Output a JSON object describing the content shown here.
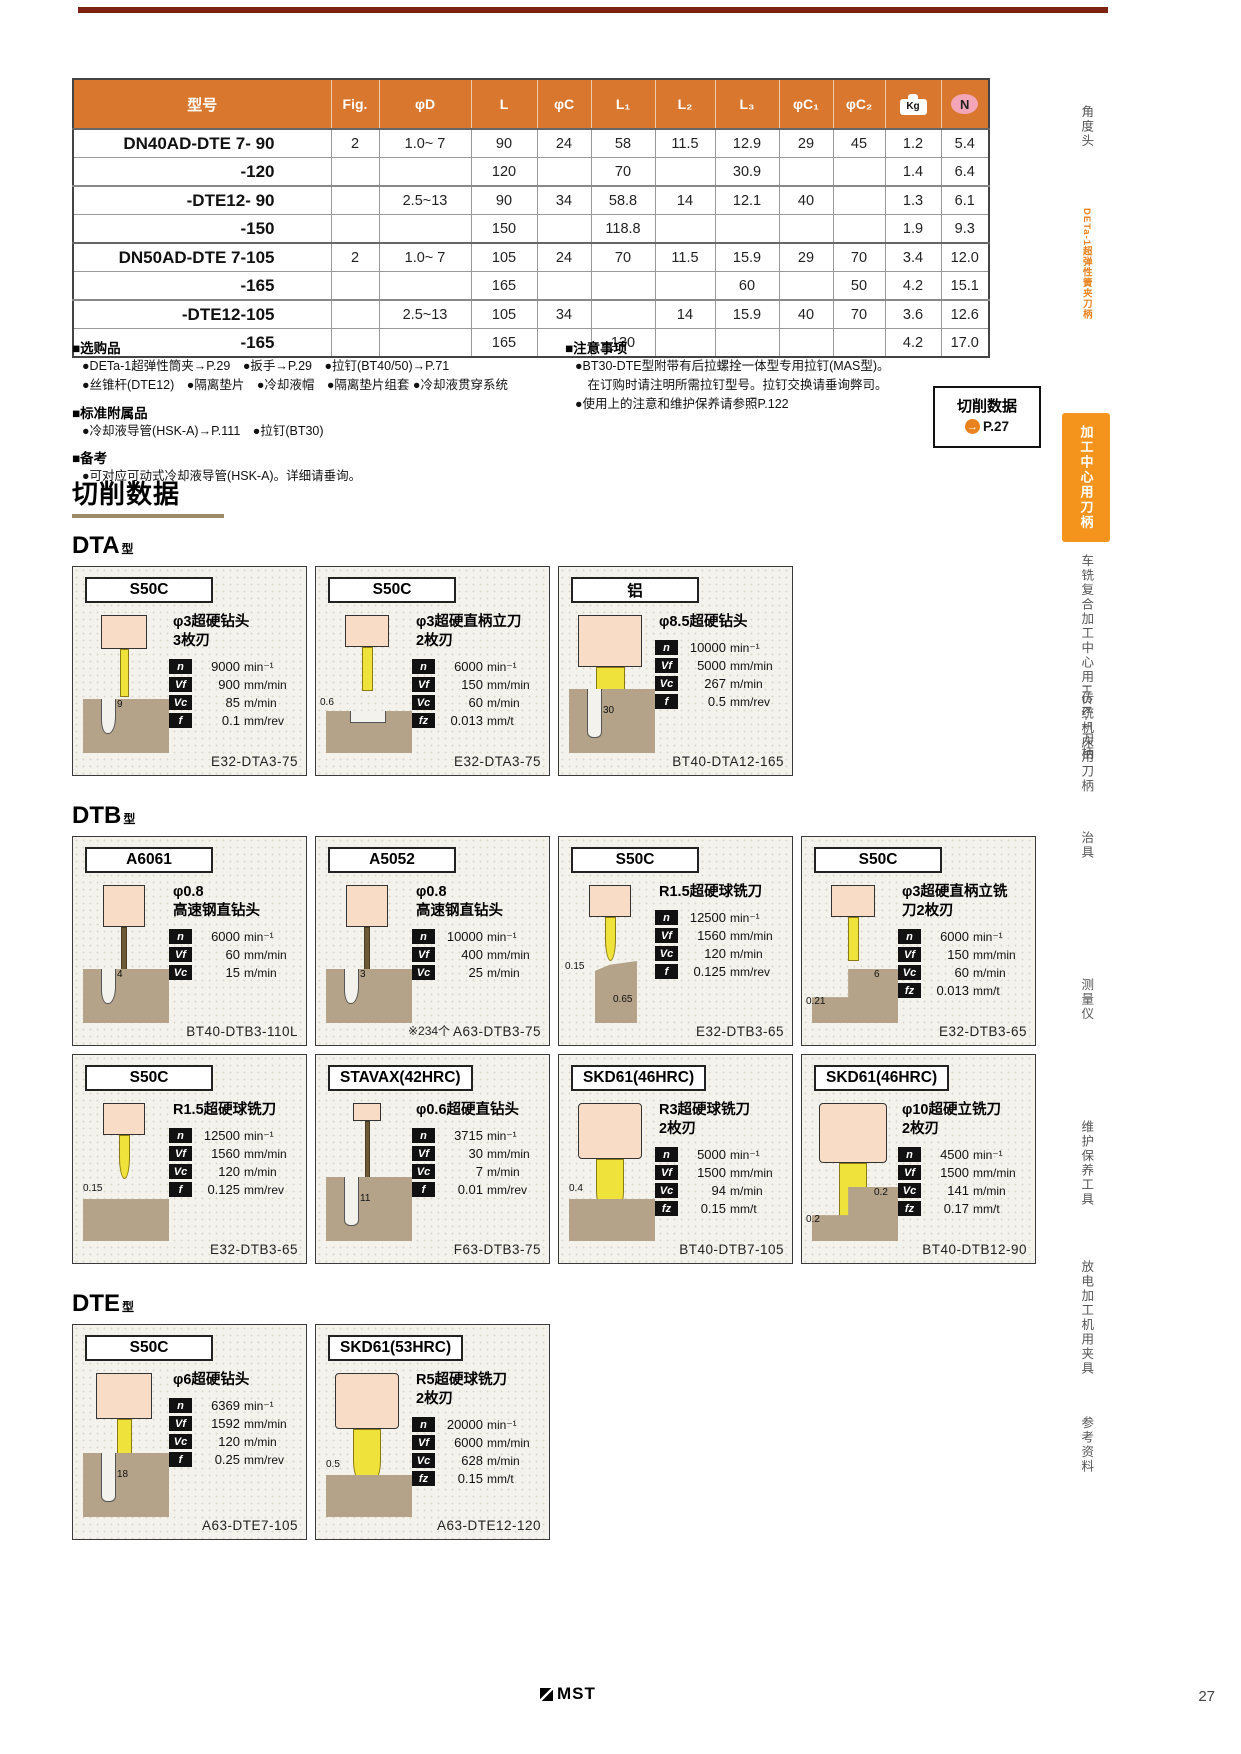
{
  "page": {
    "number": "27",
    "footer_brand": "MST"
  },
  "colors": {
    "table_header_orange": "#d9772e",
    "sidebar_active_orange": "#f5941d",
    "top_rule_maroon": "#7e2211",
    "n_badge_pink": "#f2a6b8",
    "diagram_tan": "#b4a389",
    "drill_yellow": "#efe23a",
    "holder_pink": "#f8dcc6"
  },
  "spec_table": {
    "col_headers": [
      "型号",
      "Fig.",
      "φD",
      "L",
      "φC",
      "L₁",
      "L₂",
      "L₃",
      "φC₁",
      "φC₂",
      "Kg",
      "N"
    ],
    "rows": [
      {
        "model": "DN40AD-DTE 7- 90",
        "shade": "lf",
        "sep": "group",
        "cells": [
          "2",
          "1.0~ 7",
          "90",
          "24",
          "58",
          "11.5",
          "12.9",
          "29",
          "45",
          "1.2",
          "5.4"
        ]
      },
      {
        "model": "-120",
        "shade": "l",
        "cells": [
          "",
          "",
          "120",
          "",
          "70",
          "",
          "30.9",
          "",
          "",
          "1.4",
          "6.4"
        ]
      },
      {
        "model": "-DTE12- 90",
        "shade": "l",
        "sep": "sub",
        "cells": [
          "",
          "2.5~13",
          "90",
          "34",
          "58.8",
          "14",
          "12.1",
          "40",
          "",
          "1.3",
          "6.1"
        ]
      },
      {
        "model": "-150",
        "shade": "l",
        "cells": [
          "",
          "",
          "150",
          "",
          "118.8",
          "",
          "",
          "",
          "",
          "1.9",
          "9.3"
        ]
      },
      {
        "model": "DN50AD-DTE 7-105",
        "shade": "df",
        "sep": "group",
        "cells": [
          "2",
          "1.0~ 7",
          "105",
          "24",
          "70",
          "11.5",
          "15.9",
          "29",
          "70",
          "3.4",
          "12.0"
        ]
      },
      {
        "model": "-165",
        "shade": "d",
        "cells": [
          "",
          "",
          "165",
          "",
          "",
          "",
          "60",
          "",
          "50",
          "4.2",
          "15.1"
        ]
      },
      {
        "model": "-DTE12-105",
        "shade": "d",
        "sep": "sub",
        "cells": [
          "",
          "2.5~13",
          "105",
          "34",
          "",
          "14",
          "15.9",
          "40",
          "70",
          "3.6",
          "12.6"
        ]
      },
      {
        "model": "-165",
        "shade": "d",
        "cells": [
          "",
          "",
          "165",
          "",
          "130",
          "",
          "",
          "",
          "",
          "4.2",
          "17.0"
        ]
      }
    ]
  },
  "notes_left": [
    {
      "title": "■选购品",
      "lines": [
        "●DETa-1超弹性筒夹→P.29　●扳手→P.29　●拉钉(BT40/50)→P.71",
        "●丝锥杆(DTE12)　●隔离垫片　●冷却液帽　●隔离垫片组套 ●冷却液贯穿系统"
      ]
    },
    {
      "title": "■标准附属品",
      "lines": [
        "●冷却液导管(HSK-A)→P.111　●拉钉(BT30)"
      ]
    },
    {
      "title": "■备考",
      "lines": [
        "●可对应可动式冷却液导管(HSK-A)。详细请垂询。"
      ]
    }
  ],
  "notes_right": [
    {
      "title": "■注意事项",
      "lines": [
        "●BT30-DTE型附带有后拉螺拴一体型专用拉钉(MAS型)。",
        "　在订购时请注明所需拉钉型号。拉钉交换请垂询弊司。",
        "●使用上的注意和维护保养请参照P.122"
      ]
    }
  ],
  "cutting_ref": {
    "title": "切削数据",
    "arrow": "→",
    "page": "P.27"
  },
  "cutting_section": {
    "title": "切削数据",
    "groups": [
      {
        "name": "DTA",
        "suffix": "型",
        "rows": [
          [
            {
              "material": "S50C",
              "tool": [
                "φ3超硬钻头",
                "3枚刃"
              ],
              "art": "drill-thin",
              "params": [
                [
                  "n",
                  "9000",
                  "min⁻¹"
                ],
                [
                  "Vf",
                  "900",
                  "mm/min"
                ],
                [
                  "Vc",
                  "85",
                  "m/min"
                ],
                [
                  "f",
                  "0.1",
                  "mm/rev"
                ]
              ],
              "diagram": {
                "type": "hole",
                "dims": [
                  "9"
                ]
              },
              "model": "E32-DTA3-75"
            },
            {
              "material": "S50C",
              "tool": [
                "φ3超硬直柄立刀",
                "2枚刃"
              ],
              "art": "endmill-small",
              "params": [
                [
                  "n",
                  "6000",
                  "min⁻¹"
                ],
                [
                  "Vf",
                  "150",
                  "mm/min"
                ],
                [
                  "Vc",
                  "60",
                  "m/min"
                ],
                [
                  "fz",
                  "0.013",
                  "mm/t"
                ]
              ],
              "diagram": {
                "type": "step",
                "dims": [
                  "0.6"
                ]
              },
              "model": "E32-DTA3-75"
            },
            {
              "material": "铝",
              "tool": [
                "φ8.5超硬钻头"
              ],
              "art": "drill-large",
              "params": [
                [
                  "n",
                  "10000",
                  "min⁻¹"
                ],
                [
                  "Vf",
                  "5000",
                  "mm/min"
                ],
                [
                  "Vc",
                  "267",
                  "m/min"
                ],
                [
                  "f",
                  "0.5",
                  "mm/rev"
                ]
              ],
              "diagram": {
                "type": "deep-hole",
                "dims": [
                  "30"
                ]
              },
              "model": "BT40-DTA12-165"
            }
          ]
        ]
      },
      {
        "name": "DTB",
        "suffix": "型",
        "rows": [
          [
            {
              "material": "A6061",
              "tool": [
                "φ0.8",
                "高速钢直钻头"
              ],
              "art": "drill-hair",
              "params": [
                [
                  "n",
                  "6000",
                  "min⁻¹"
                ],
                [
                  "Vf",
                  "60",
                  "mm/min"
                ],
                [
                  "Vc",
                  "15",
                  "m/min"
                ]
              ],
              "diagram": {
                "type": "hole",
                "dims": [
                  "4"
                ]
              },
              "model": "BT40-DTB3-110L"
            },
            {
              "material": "A5052",
              "tool": [
                "φ0.8",
                "高速钢直钻头"
              ],
              "art": "drill-hair",
              "params": [
                [
                  "n",
                  "10000",
                  "min⁻¹"
                ],
                [
                  "Vf",
                  "400",
                  "mm/min"
                ],
                [
                  "Vc",
                  "25",
                  "m/min"
                ]
              ],
              "diagram": {
                "type": "hole",
                "dims": [
                  "3"
                ]
              },
              "note": "※234个",
              "model": "A63-DTB3-75"
            },
            {
              "material": "S50C",
              "tool": [
                "R1.5超硬球铣刀"
              ],
              "art": "ballmill-small",
              "params": [
                [
                  "n",
                  "12500",
                  "min⁻¹"
                ],
                [
                  "Vf",
                  "1560",
                  "mm/min"
                ],
                [
                  "Vc",
                  "120",
                  "m/min"
                ],
                [
                  "f",
                  "0.125",
                  "mm/rev"
                ]
              ],
              "diagram": {
                "type": "corner",
                "dims": [
                  "0.15",
                  "0.65"
                ]
              },
              "model": "E32-DTB3-65"
            },
            {
              "material": "S50C",
              "tool": [
                "φ3超硬直柄立铣",
                "刀2枚刃"
              ],
              "art": "endmill-small",
              "params": [
                [
                  "n",
                  "6000",
                  "min⁻¹"
                ],
                [
                  "Vf",
                  "150",
                  "mm/min"
                ],
                [
                  "Vc",
                  "60",
                  "m/min"
                ],
                [
                  "fz",
                  "0.013",
                  "mm/t"
                ]
              ],
              "diagram": {
                "type": "lstep",
                "dims": [
                  "6",
                  "0.21"
                ]
              },
              "model": "E32-DTB3-65"
            }
          ],
          [
            {
              "material": "S50C",
              "tool": [
                "R1.5超硬球铣刀"
              ],
              "art": "ballmill-small",
              "params": [
                [
                  "n",
                  "12500",
                  "min⁻¹"
                ],
                [
                  "Vf",
                  "1560",
                  "mm/min"
                ],
                [
                  "Vc",
                  "120",
                  "m/min"
                ],
                [
                  "f",
                  "0.125",
                  "mm/rev"
                ]
              ],
              "diagram": {
                "type": "surface",
                "dims": [
                  "0.15"
                ]
              },
              "model": "E32-DTB3-65"
            },
            {
              "material": "STAVAX(42HRC)",
              "tool": [
                "φ0.6超硬直钻头"
              ],
              "art": "drill-hair-long",
              "params": [
                [
                  "n",
                  "3715",
                  "min⁻¹"
                ],
                [
                  "Vf",
                  "30",
                  "mm/min"
                ],
                [
                  "Vc",
                  "7",
                  "m/min"
                ],
                [
                  "f",
                  "0.01",
                  "mm/rev"
                ]
              ],
              "diagram": {
                "type": "deep-hole",
                "dims": [
                  "11"
                ]
              },
              "model": "F63-DTB3-75"
            },
            {
              "material": "SKD61(46HRC)",
              "tool": [
                "R3超硬球铣刀",
                "2枚刃"
              ],
              "art": "ballmill-large",
              "params": [
                [
                  "n",
                  "5000",
                  "min⁻¹"
                ],
                [
                  "Vf",
                  "1500",
                  "mm/min"
                ],
                [
                  "Vc",
                  "94",
                  "m/min"
                ],
                [
                  "fz",
                  "0.15",
                  "mm/t"
                ]
              ],
              "diagram": {
                "type": "surface",
                "dims": [
                  "0.4"
                ]
              },
              "model": "BT40-DTB7-105"
            },
            {
              "material": "SKD61(46HRC)",
              "tool": [
                "φ10超硬立铣刀",
                "2枚刃"
              ],
              "art": "endmill-large",
              "params": [
                [
                  "n",
                  "4500",
                  "min⁻¹"
                ],
                [
                  "Vf",
                  "1500",
                  "mm/min"
                ],
                [
                  "Vc",
                  "141",
                  "m/min"
                ],
                [
                  "fz",
                  "0.17",
                  "mm/t"
                ]
              ],
              "diagram": {
                "type": "lstep",
                "dims": [
                  "0.2",
                  "0.2"
                ]
              },
              "model": "BT40-DTB12-90"
            }
          ]
        ]
      },
      {
        "name": "DTE",
        "suffix": "型",
        "rows": [
          [
            {
              "material": "S50C",
              "tool": [
                "φ6超硬钻头"
              ],
              "art": "drill-medium",
              "params": [
                [
                  "n",
                  "6369",
                  "min⁻¹"
                ],
                [
                  "Vf",
                  "1592",
                  "mm/min"
                ],
                [
                  "Vc",
                  "120",
                  "m/min"
                ],
                [
                  "f",
                  "0.25",
                  "mm/rev"
                ]
              ],
              "diagram": {
                "type": "deep-hole",
                "dims": [
                  "18"
                ]
              },
              "model": "A63-DTE7-105"
            },
            {
              "material": "SKD61(53HRC)",
              "tool": [
                "R5超硬球铣刀",
                "2枚刃"
              ],
              "art": "ballmill-large",
              "params": [
                [
                  "n",
                  "20000",
                  "min⁻¹"
                ],
                [
                  "Vf",
                  "6000",
                  "mm/min"
                ],
                [
                  "Vc",
                  "628",
                  "m/min"
                ],
                [
                  "fz",
                  "0.15",
                  "mm/t"
                ]
              ],
              "diagram": {
                "type": "surface",
                "dims": [
                  "0.5"
                ]
              },
              "model": "A63-DTE12-120"
            }
          ]
        ]
      }
    ]
  },
  "sidebar": {
    "items": [
      {
        "label": "角度头",
        "style": "normal"
      },
      {
        "label": "DETa-1超弹性簧夹刀柄",
        "style": "orange-text"
      },
      {
        "label": "加工中心用刀柄",
        "style": "active"
      },
      {
        "label": "车铣复合加工中心用HSK-T刀柄",
        "style": "normal"
      },
      {
        "label": "传统机床用刀柄",
        "style": "normal"
      },
      {
        "label": "治具",
        "style": "normal"
      },
      {
        "label": "测量仪",
        "style": "normal"
      },
      {
        "label": "维护保养工具",
        "style": "normal"
      },
      {
        "label": "放电加工机用夹具",
        "style": "normal"
      },
      {
        "label": "参考资料",
        "style": "normal"
      }
    ]
  }
}
